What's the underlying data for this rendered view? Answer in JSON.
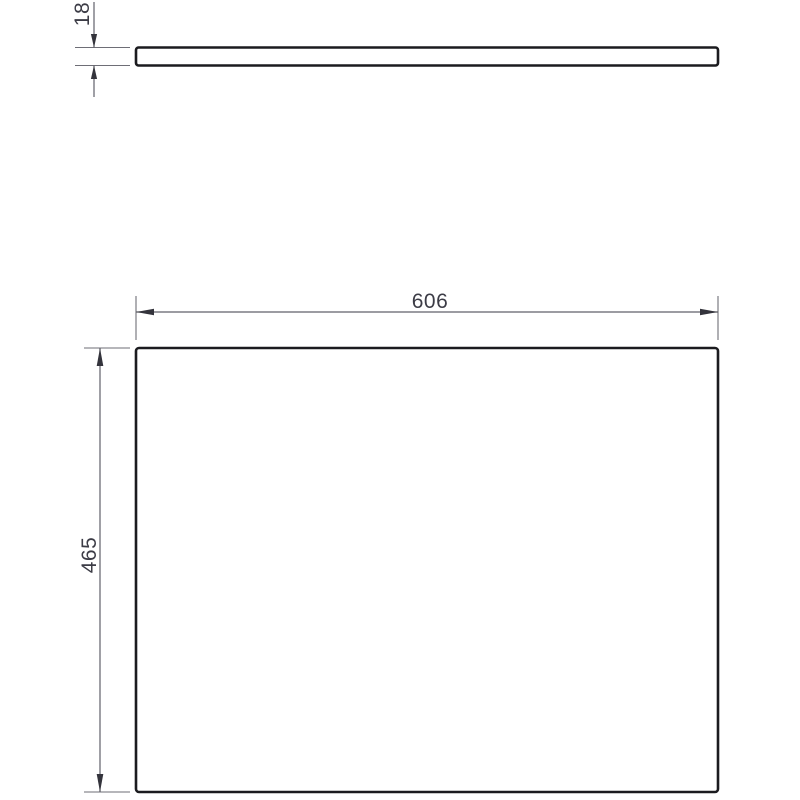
{
  "dimensions": {
    "thickness": {
      "label": "18"
    },
    "width": {
      "label": "606"
    },
    "height": {
      "label": "465"
    }
  },
  "colors": {
    "object-stroke": "#1b1b1f",
    "dimension-line": "#60606a",
    "extension-line": "#6e6e76",
    "arrow": "#34343c",
    "label-text": "#3c3c46",
    "background": "#ffffff"
  }
}
